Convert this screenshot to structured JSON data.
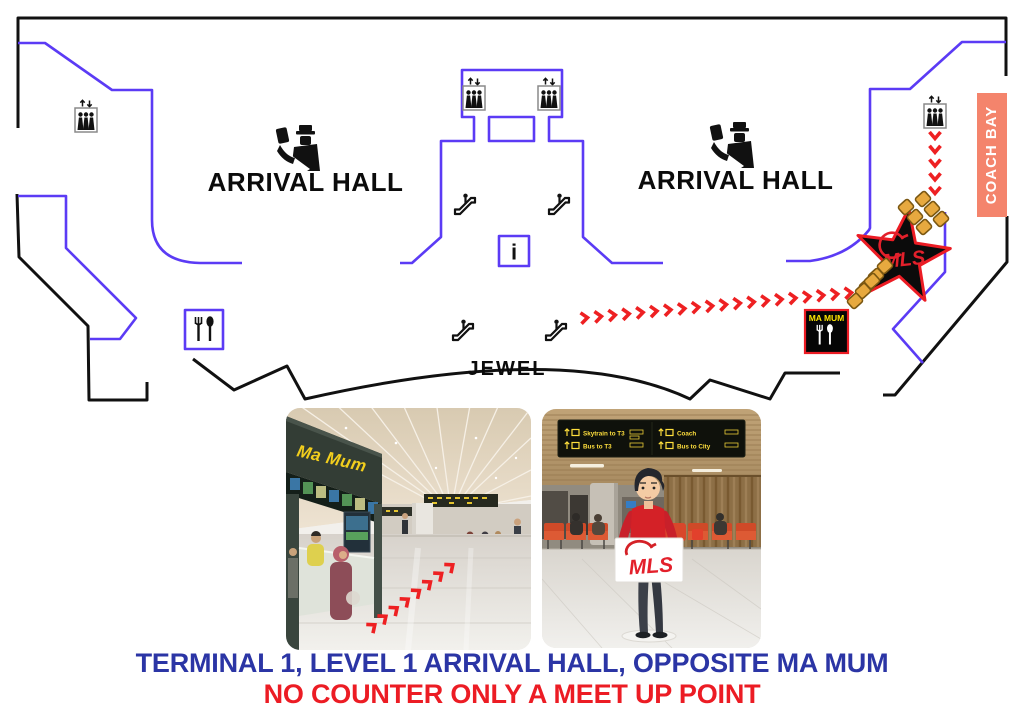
{
  "map": {
    "left_hall": "ARRIVAL HALL",
    "right_hall": "ARRIVAL HALL",
    "jewel": "JEWEL",
    "coach_bay": "COACH BAY",
    "ma_mum": "MA MUM",
    "mls": "MLS",
    "info_i": "i",
    "icons": [
      "lift-icon",
      "escalator-icon",
      "immigration-icon",
      "info-icon",
      "restaurant-icon",
      "fork-spoon-icon",
      "meet-point-star"
    ],
    "routes": [
      {
        "name": "walkway-to-meet-point",
        "x1": 584,
        "y1": 318,
        "x2": 848,
        "y2": 293,
        "count": 20
      },
      {
        "name": "lift-to-coach-bay",
        "x1": 935,
        "y1": 135,
        "x2": 935,
        "y2": 190,
        "count": 5
      },
      {
        "name": "photo-walkway-route",
        "x1": 372,
        "y1": 627,
        "x2": 450,
        "y2": 567,
        "count": 8
      }
    ]
  },
  "photos": {
    "left": {
      "shop_sign": "Ma Mum"
    },
    "right": {
      "overhead_sign": [
        "Skytrain to T3",
        "Bus to T3",
        "Coach",
        "Bus to City"
      ],
      "mls_sign": "MLS"
    }
  },
  "captions": {
    "line1": "TERMINAL 1, LEVEL 1 ARRIVAL HALL, OPPOSITE MA MUM",
    "line2": "NO COUNTER ONLY A MEET UP POINT"
  },
  "colors": {
    "wall_blue": "#5B3BF5",
    "route_red": "#EE2022",
    "caption_blue": "#2B35A5",
    "caption_red": "#EC1C24",
    "coach_bay_bg": "#F4846C",
    "ma_mum_yellow": "#FFE600",
    "gold_fill": "#E7A93F",
    "gold_border": "#7A5712",
    "star_outline": "#EC1C24",
    "mls_red": "#E3202B"
  }
}
